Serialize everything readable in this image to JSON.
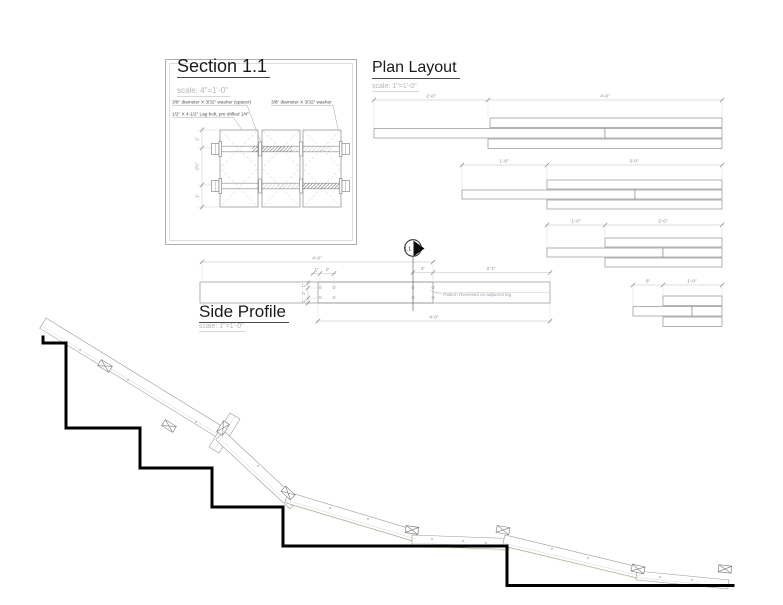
{
  "document": {
    "background": "#ffffff",
    "line_color": "#000000",
    "dim_color": "#999999",
    "note_color": "#98a0aa"
  },
  "section": {
    "title": "Section 1.1",
    "scale": "scale: 4\"=1'-0\"",
    "callouts": {
      "washer_spacer": "3/8\" diameter X 3/32\" washer (spacer)",
      "washer": "3/8\" diameter X 3/32\" washer",
      "lag_bolt": "1/2\" X 4-1/2\" Lag bolt, pre drilled 1/4\""
    },
    "dims_vertical": [
      "1\"",
      "2½\"",
      "1\""
    ]
  },
  "plan": {
    "title": "Plan Layout",
    "scale": "scale: 1\"=1'-0\"",
    "groups": [
      {
        "offset_dim": "2'-0\"",
        "length_dim": "4'-0\""
      },
      {
        "offset_dim": "1'-6\"",
        "length_dim": "3'-0\""
      },
      {
        "offset_dim": "1'-0\"",
        "length_dim": "2'-0\""
      },
      {
        "offset_dim": "6\"",
        "length_dim": "1'-0\""
      }
    ]
  },
  "side": {
    "title": "Side Profile",
    "scale": "scale: 1\"=1'-0\"",
    "marker": "1.1",
    "note": "Pattern Reversed on adjacent leg",
    "dims": {
      "overall_top": "4'-0\"",
      "overall_bottom": "4'-0\"",
      "hole_dim_1": "1\"",
      "hole_dim_2": "2\"",
      "gap": "2\"",
      "remainder": "2'-1\"",
      "vertical": [
        "1\"",
        "2\"",
        "1\""
      ]
    }
  }
}
